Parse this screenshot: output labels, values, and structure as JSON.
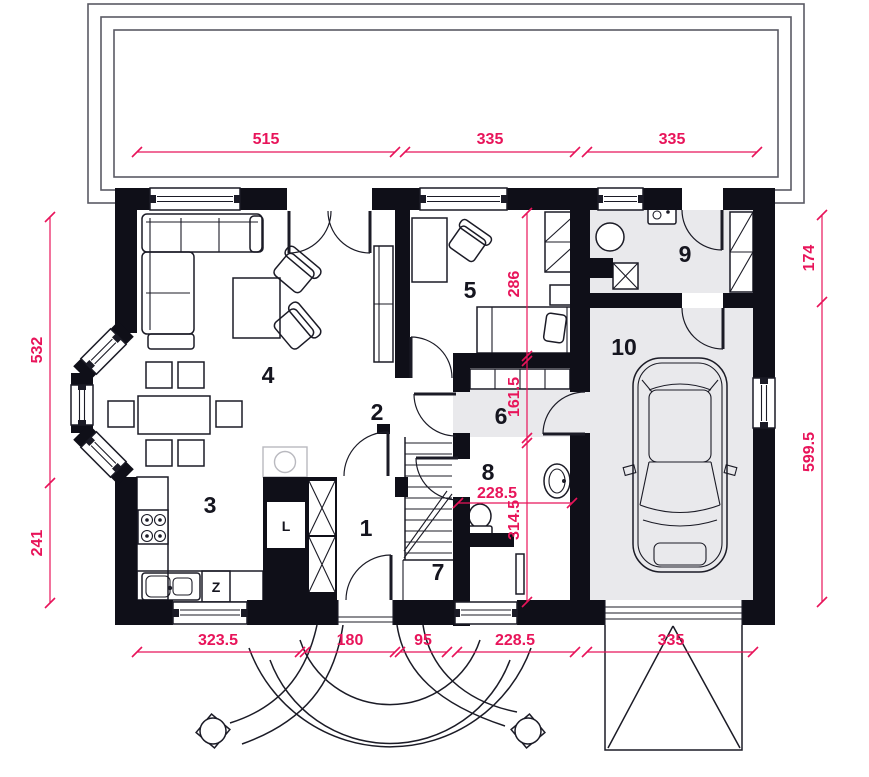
{
  "plan": {
    "rooms": [
      "1",
      "2",
      "3",
      "4",
      "5",
      "6",
      "7",
      "8",
      "9",
      "10"
    ],
    "appliances": {
      "fridge": "L",
      "dishwasher": "Z"
    },
    "dimensions": {
      "top": [
        "515",
        "335",
        "335"
      ],
      "bottom": [
        "323.5",
        "180",
        "95",
        "228.5",
        "335"
      ],
      "left": [
        "532",
        "241"
      ],
      "right": [
        "174",
        "599.5"
      ],
      "interior_vertical": [
        "286",
        "161.5",
        "314.5"
      ],
      "interior_horizontal": [
        "228.5"
      ]
    },
    "colors": {
      "dimension": "#e8145a",
      "wall": "#0f0f18",
      "floor_gray": "#e9e9ec",
      "line": "#1b1b26"
    }
  }
}
